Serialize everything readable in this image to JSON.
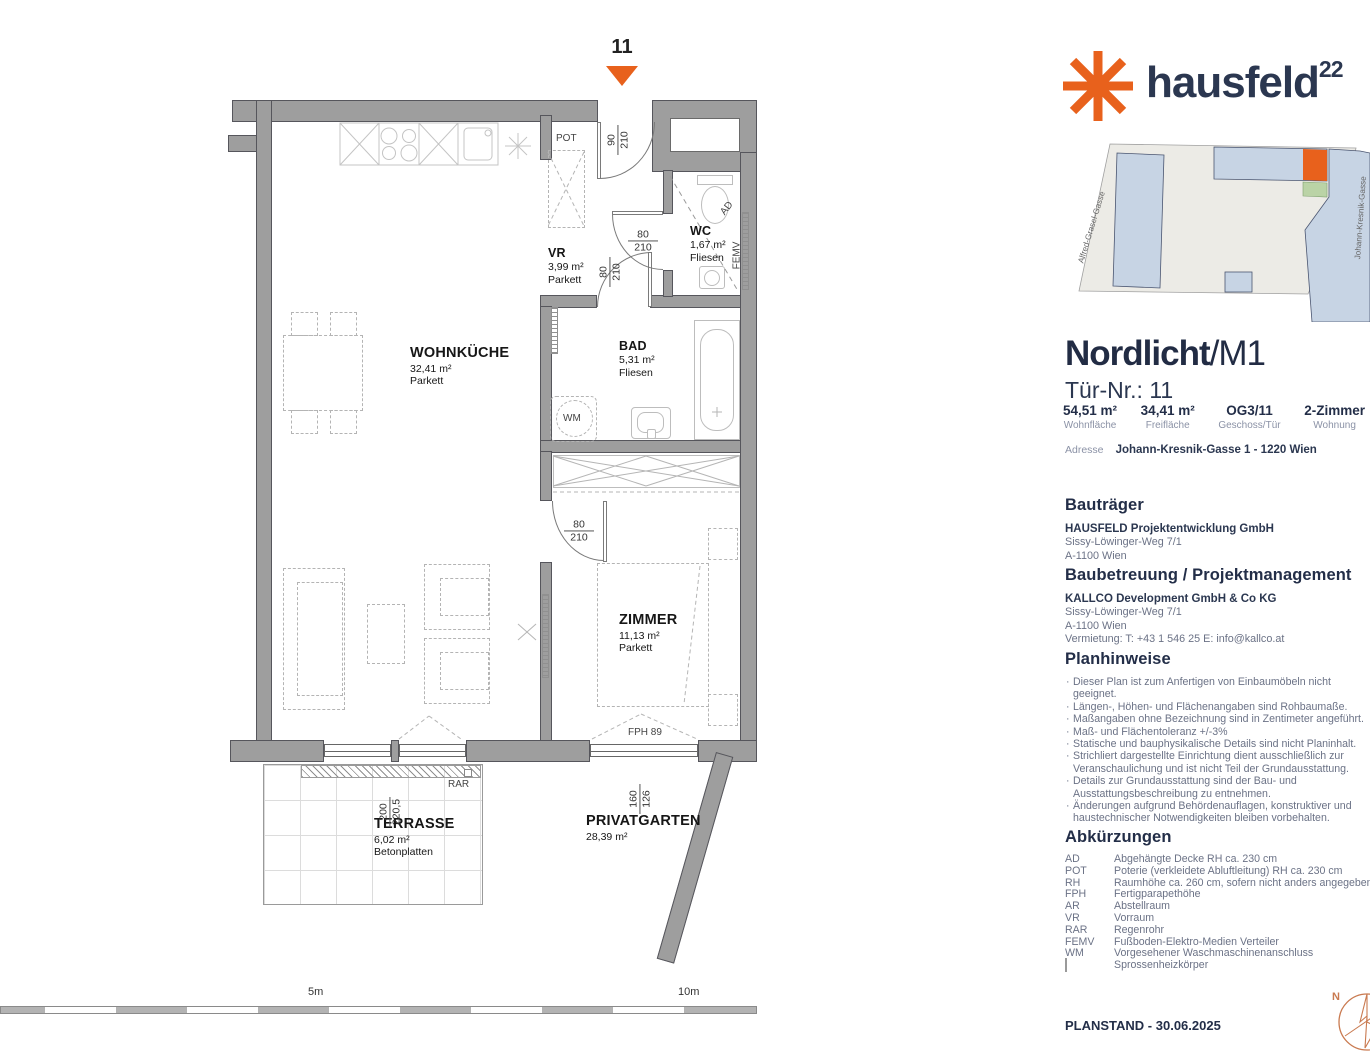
{
  "plan": {
    "unit_marker": "11",
    "rooms": [
      {
        "name": "WOHNKÜCHE",
        "area": "32,41 m²",
        "floor": "Parkett"
      },
      {
        "name": "VR",
        "area": "3,99 m²",
        "floor": "Parkett"
      },
      {
        "name": "WC",
        "area": "1,67 m²",
        "floor": "Fliesen"
      },
      {
        "name": "BAD",
        "area": "5,31 m²",
        "floor": "Fliesen"
      },
      {
        "name": "ZIMMER",
        "area": "11,13 m²",
        "floor": "Parkett"
      },
      {
        "name": "TERRASSE",
        "area": "6,02 m²",
        "floor": "Betonplatten"
      },
      {
        "name": "PRIVATGARTEN",
        "area": "28,39 m²",
        "floor": ""
      }
    ],
    "dims": {
      "entrance": {
        "w": "90",
        "h": "210"
      },
      "wc_door": {
        "w": "80",
        "h": "210"
      },
      "bad_door": {
        "w": "80",
        "h": "210"
      },
      "zimmer_door": {
        "w": "80",
        "h": "210"
      },
      "terrace_door": {
        "w": "200",
        "h": "220,5"
      },
      "zimmer_window": {
        "w": "160",
        "h": "126"
      },
      "fph": "FPH 89"
    },
    "annotations": {
      "pot": "POT",
      "rar": "RAR",
      "ad": "AD",
      "femv": "FEMV",
      "wm": "WM"
    },
    "scale": {
      "mid": "5m",
      "end": "10m"
    }
  },
  "panel": {
    "logo": {
      "text": "hausfeld",
      "sup": "22"
    },
    "site_plan": {
      "street_left": "Alfred-Grasel-Gasse",
      "street_right": "Johann-Kresnik-Gasse"
    },
    "title": {
      "project": "Nordlicht",
      "unit": "/M1",
      "door": "Tür-Nr.: 11"
    },
    "stats": [
      {
        "value": "54,51 m²",
        "label": "Wohnfläche"
      },
      {
        "value": "34,41 m²",
        "label": "Freifläche"
      },
      {
        "value": "OG3/11",
        "label": "Geschoss/Tür"
      },
      {
        "value": "2-Zimmer",
        "label": "Wohnung"
      }
    ],
    "address": {
      "label": "Adresse",
      "value": "Johann-Kresnik-Gasse 1 - 1220 Wien"
    },
    "developer": {
      "heading": "Bauträger",
      "name": "HAUSFELD Projektentwicklung GmbH",
      "line1": "Sissy-Löwinger-Weg 7/1",
      "line2": "A-1100 Wien"
    },
    "management": {
      "heading": "Baubetreuung / Projektmanagement",
      "name": "KALLCO Development GmbH & Co KG",
      "line1": "Sissy-Löwinger-Weg 7/1",
      "line2": "A-1100 Wien",
      "line3": "Vermietung: T: +43 1 546 25  E: info@kallco.at"
    },
    "notes": {
      "heading": "Planhinweise",
      "items": [
        "Dieser Plan ist zum Anfertigen von Einbaumöbeln nicht geeignet.",
        "Längen-, Höhen- und Flächenangaben sind Rohbaumaße.",
        "Maßangaben ohne Bezeichnung sind in Zentimeter angeführt.",
        "Maß- und Flächentoleranz +/-3%",
        "Statische und bauphysikalische Details sind nicht Planinhalt.",
        "Strichliert dargestellte Einrichtung dient ausschließlich zur Veranschaulichung und ist nicht Teil der Grundausstattung.",
        "Details zur Grundausstattung sind der Bau- und Ausstattungsbeschreibung zu entnehmen.",
        "Änderungen aufgrund Behördenauflagen, konstruktiver und haustechnischer Notwendigkeiten bleiben vorbehalten."
      ]
    },
    "abbrev": {
      "heading": "Abkürzungen",
      "rows": [
        {
          "k": "AD",
          "v": "Abgehängte Decke RH ca. 230 cm"
        },
        {
          "k": "POT",
          "v": "Poterie (verkleidete Abluftleitung) RH ca. 230 cm"
        },
        {
          "k": "RH",
          "v": "Raumhöhe ca. 260 cm, sofern nicht anders angegeben"
        },
        {
          "k": "FPH",
          "v": "Fertigparapethöhe"
        },
        {
          "k": "AR",
          "v": "Abstellraum"
        },
        {
          "k": "VR",
          "v": "Vorraum"
        },
        {
          "k": "RAR",
          "v": "Regenrohr"
        },
        {
          "k": "FEMV",
          "v": "Fußboden-Elektro-Medien Verteiler"
        },
        {
          "k": "WM",
          "v": "Vorgesehener Waschmaschinenanschluss"
        },
        {
          "k": "",
          "v": "Sprossenheizkörper"
        }
      ]
    },
    "planstand": "PLANSTAND - 30.06.2025",
    "compass": {
      "n": "N"
    },
    "colors": {
      "accent": "#E8611C",
      "navy": "#2B3750",
      "wall": "#9E9E9E",
      "building_blue": "#C7D4E4",
      "parcel": "#ECEBE6",
      "highlight_green": "#BAD3A6"
    }
  }
}
